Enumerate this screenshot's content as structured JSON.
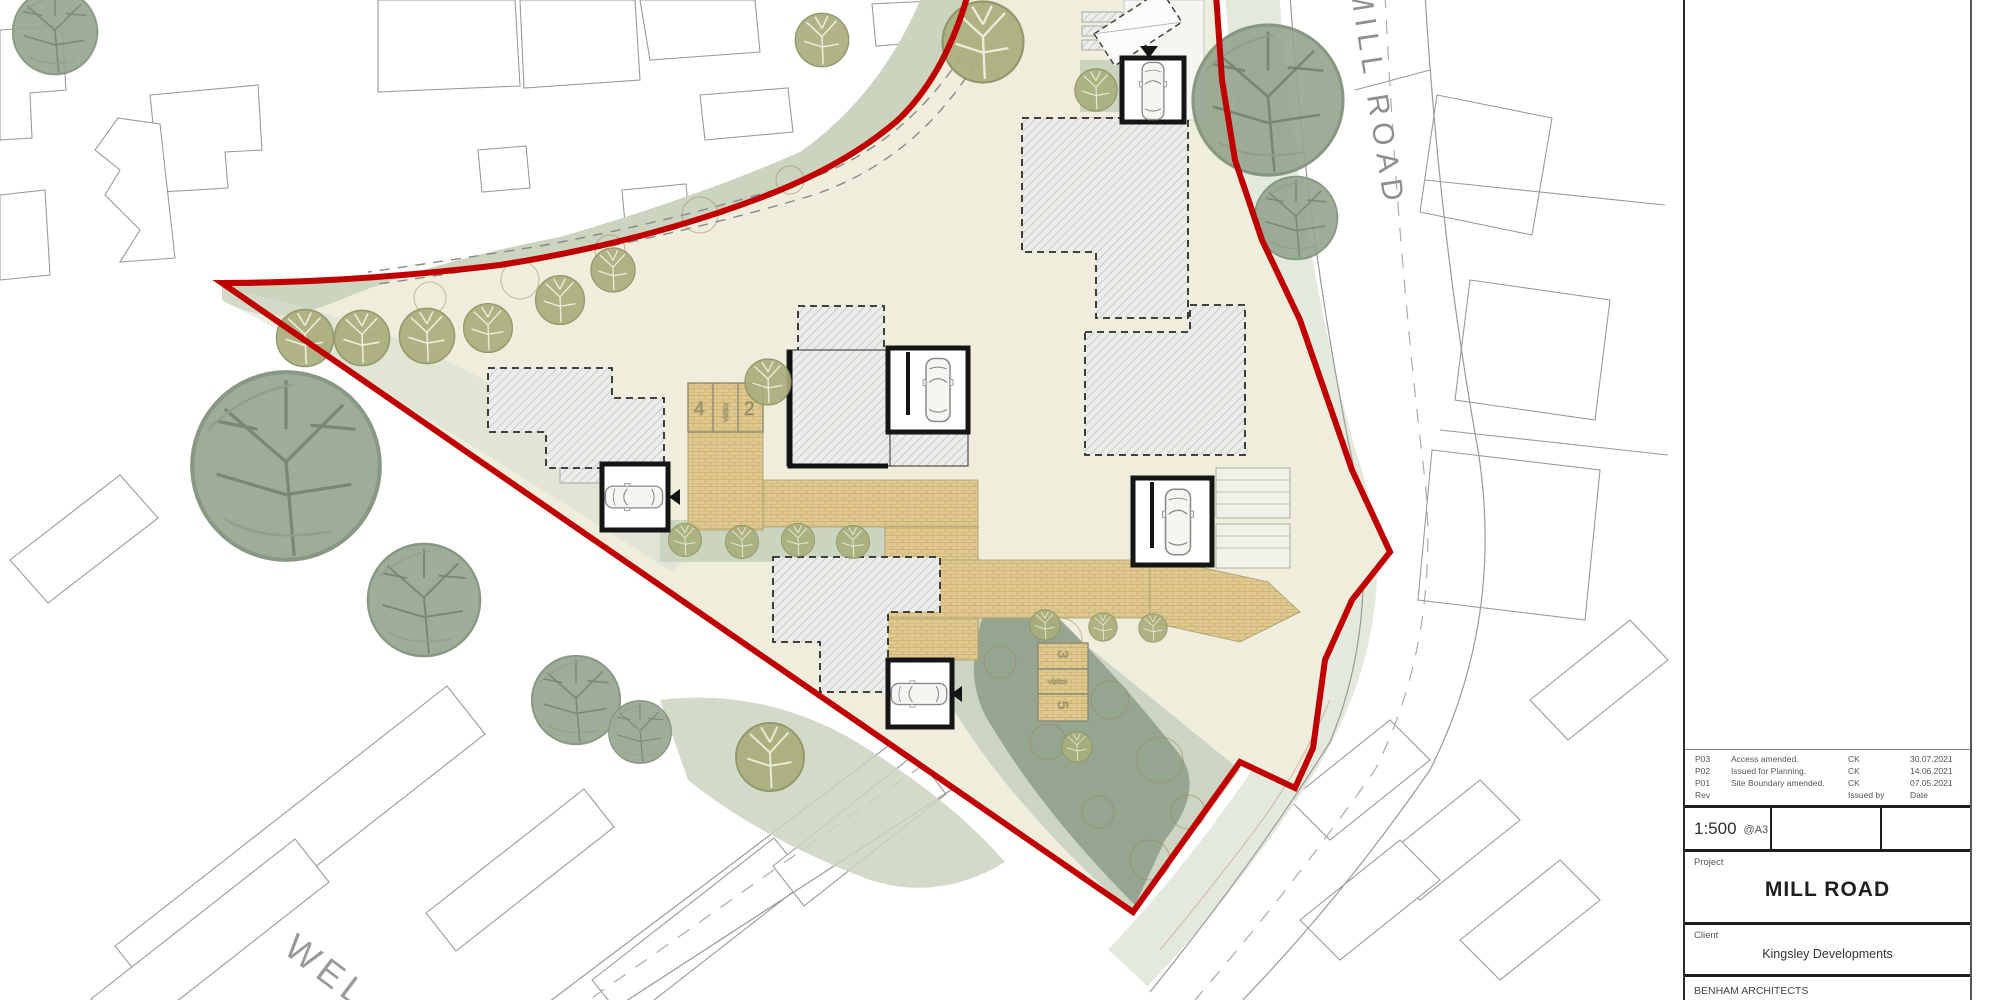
{
  "plan": {
    "road_label_top": "MILL ROAD",
    "road_label_bottom": "WEL",
    "parking_bays_nw": [
      "4",
      "visitor",
      "2"
    ],
    "parking_bays_se": [
      "3",
      "visitor",
      "5"
    ]
  },
  "title_block": {
    "revisions": [
      {
        "rev": "P03",
        "description": "Access amended.",
        "issued_by": "CK",
        "date": "30.07.2021"
      },
      {
        "rev": "P02",
        "description": "Issued for Planning.",
        "issued_by": "CK",
        "date": "14.06.2021"
      },
      {
        "rev": "P01",
        "description": "Site Boundary amended.",
        "issued_by": "CK",
        "date": "07.05.2021"
      }
    ],
    "revision_footer": {
      "rev": "Rev",
      "issued_by": "Issued by",
      "date": "Date"
    },
    "scale": "1:500",
    "paper_size": "@A3",
    "project_label": "Project",
    "project_name": "MILL ROAD",
    "client_label": "Client",
    "client_name": "Kingsley Developments",
    "practice_name": "BENHAM ARCHITECTS"
  },
  "colors": {
    "site_boundary_red": "#C00000",
    "landscape_sage": "#CBD4BF",
    "tree_olive": "#A9AE7C",
    "tree_sage": "#96A58F",
    "paving_tan": "#DFC98E",
    "building_hatch_fill": "#ECECEA",
    "context_line_grey": "#9A9A9A"
  }
}
